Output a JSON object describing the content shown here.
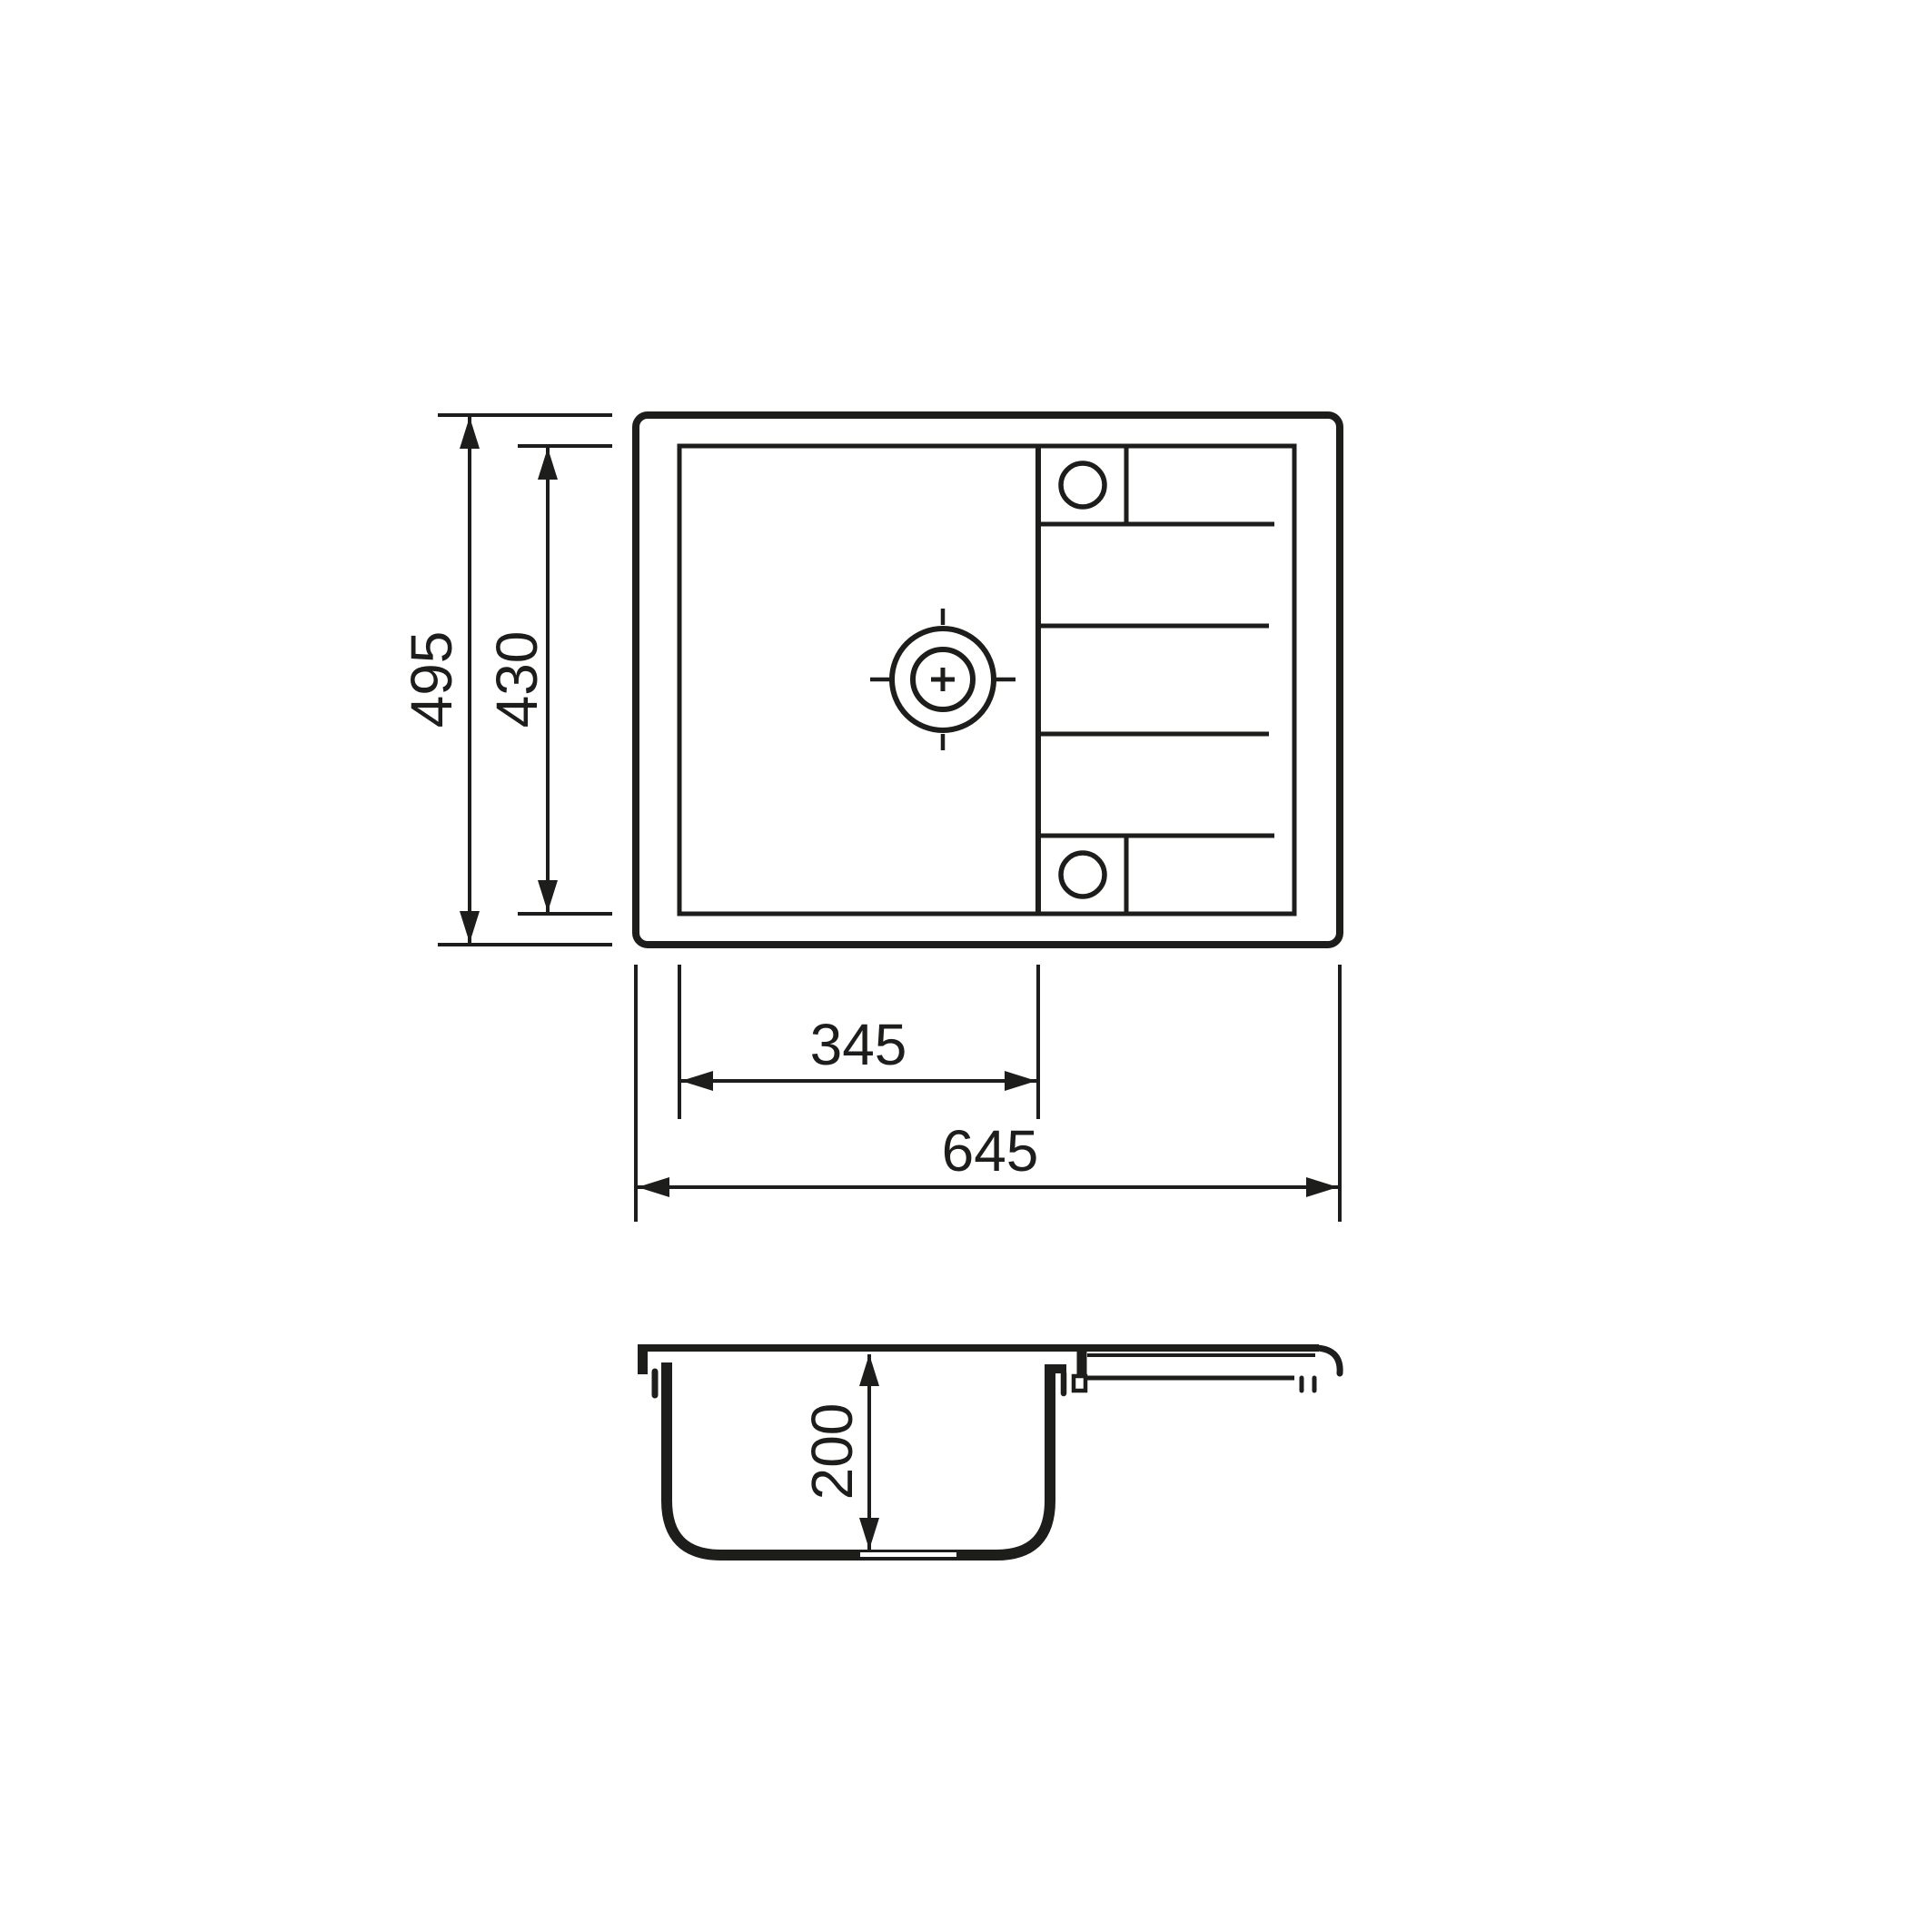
{
  "document": {
    "type": "technical drawing",
    "subject": "kitchen sink with drainer, plan view and section view",
    "background_color": "#ffffff",
    "line_color": "#1d1d1b"
  },
  "top_view": {
    "dim_overall_height": "495",
    "dim_bowl_height": "430",
    "dim_bowl_width": "345",
    "dim_overall_width": "645"
  },
  "section_view": {
    "dim_bowl_depth": "200"
  }
}
